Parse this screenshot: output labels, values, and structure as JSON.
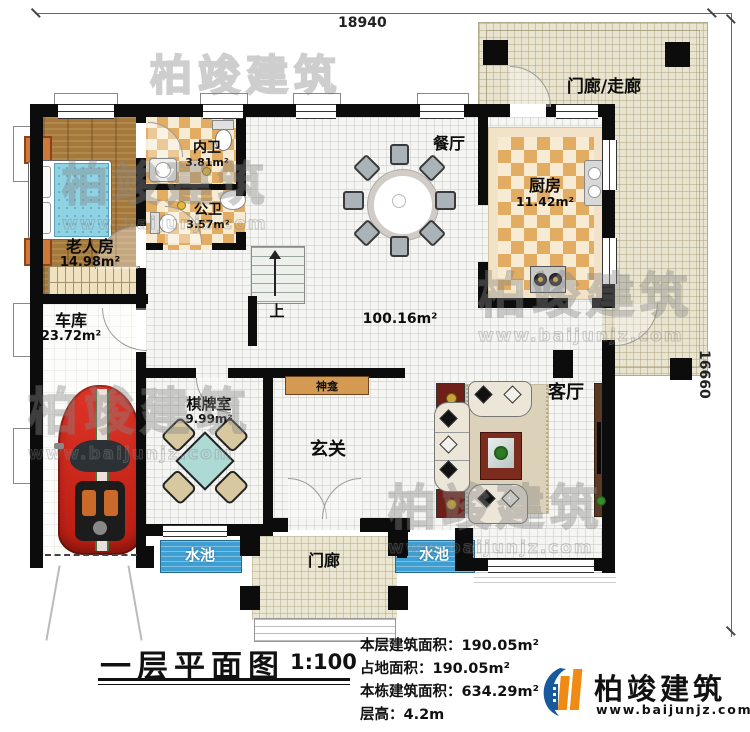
{
  "dim_top": "18940",
  "dim_right": "16660",
  "rooms": {
    "corridor": {
      "label": "门廊/走廊"
    },
    "dining": {
      "label": "餐厅"
    },
    "kitchen": {
      "label": "厨房",
      "area": "11.42m²"
    },
    "inner_bath": {
      "label": "内卫",
      "area": "3.81m²"
    },
    "public_bath": {
      "label": "公卫",
      "area": "3.57m²"
    },
    "elder_room": {
      "label": "老人房",
      "area": "14.98m²"
    },
    "garage": {
      "label": "车库",
      "area": "23.72m²"
    },
    "chess_room": {
      "label": "棋牌室",
      "area": "9.99m²"
    },
    "entry": {
      "label": "玄关"
    },
    "living": {
      "label": "客厅"
    },
    "shrine": {
      "label": "神龛"
    },
    "porch": {
      "label": "门廊"
    },
    "pool_left": {
      "label": "水池"
    },
    "pool_right": {
      "label": "水池"
    },
    "hall_area": {
      "label": "100.16m²"
    },
    "stairs_up": {
      "label": "上"
    }
  },
  "title_block": {
    "title": "一层平面图",
    "scale": "1:100",
    "stats": [
      {
        "label": "本层建筑面积：",
        "value": "190.05m²"
      },
      {
        "label": "占地面积：",
        "value": "190.05m²"
      },
      {
        "label": "本栋建筑面积：",
        "value": "634.29m²"
      },
      {
        "label": "层高：",
        "value": "4.2m"
      }
    ]
  },
  "logo": {
    "name": "柏竣建筑",
    "url": "www.baijunjz.com"
  },
  "watermark": {
    "line1": "柏竣建筑",
    "line2": "www.baijunjz.com"
  }
}
